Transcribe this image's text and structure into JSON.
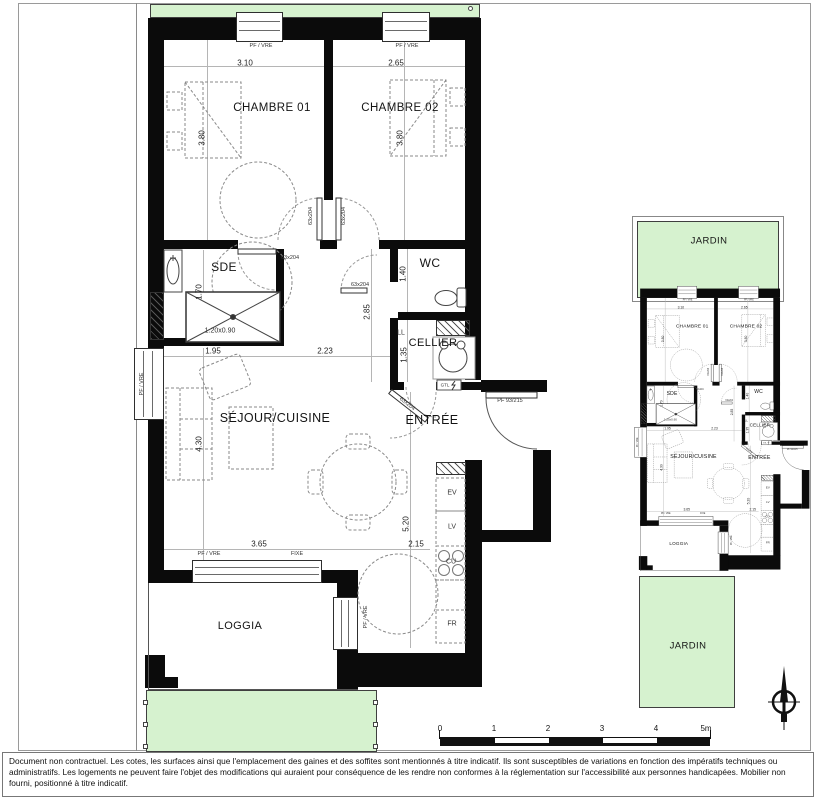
{
  "rooms": {
    "chambre1": "CHAMBRE 01",
    "chambre2": "CHAMBRE 02",
    "sde": "SDE",
    "wc": "WC",
    "cellier": "CELLIER",
    "sejour": "SÉJOUR/CUISINE",
    "entree": "ENTRÉE",
    "loggia": "LOGGIA",
    "jardin": "JARDIN"
  },
  "dims": {
    "w_ch1": "3.10",
    "w_ch2": "2.65",
    "h_ch1": "3.80",
    "h_ch2": "3.80",
    "h_sde": "1.70",
    "shower": "1.20x0.90",
    "h_wc": "1.40",
    "h_hall": "2.85",
    "h_cellier": "1.35",
    "w_sejour_a": "1.95",
    "w_sejour_b": "2.23",
    "h_sejour": "4.30",
    "h_kitchen": "5.20",
    "w_kitchen": "2.15",
    "w_loggia": "3.65"
  },
  "labels": {
    "window": "PF / VRE",
    "fixed_window": "FIXE",
    "door_interior": "63x204",
    "door_entry": "PF 93/215",
    "washer": "LL",
    "gtl": "GTL",
    "sink": "EV",
    "dishwasher": "LV",
    "hob": "CU",
    "fridge": "FR"
  },
  "scalebar": {
    "ticks": [
      "0",
      "1",
      "2",
      "3",
      "4",
      "5m"
    ]
  },
  "disclaimer": "Document non contractuel. Les cotes, les surfaces ainsi que l'emplacement des gaines et des soffites sont mentionnés à titre indicatif. Ils sont susceptibles de variations en fonction des impératifs techniques ou administratifs. Les logements ne peuvent faire l'objet des modifications qui auraient pour conséquence de les rendre non conformes à la réglementation sur l'accessibilité aux personnes handicapées. Mobilier non fourni, positionné à titre indicatif.",
  "colors": {
    "garden": "#d6f2cf",
    "wall": "#0b0b0b"
  }
}
